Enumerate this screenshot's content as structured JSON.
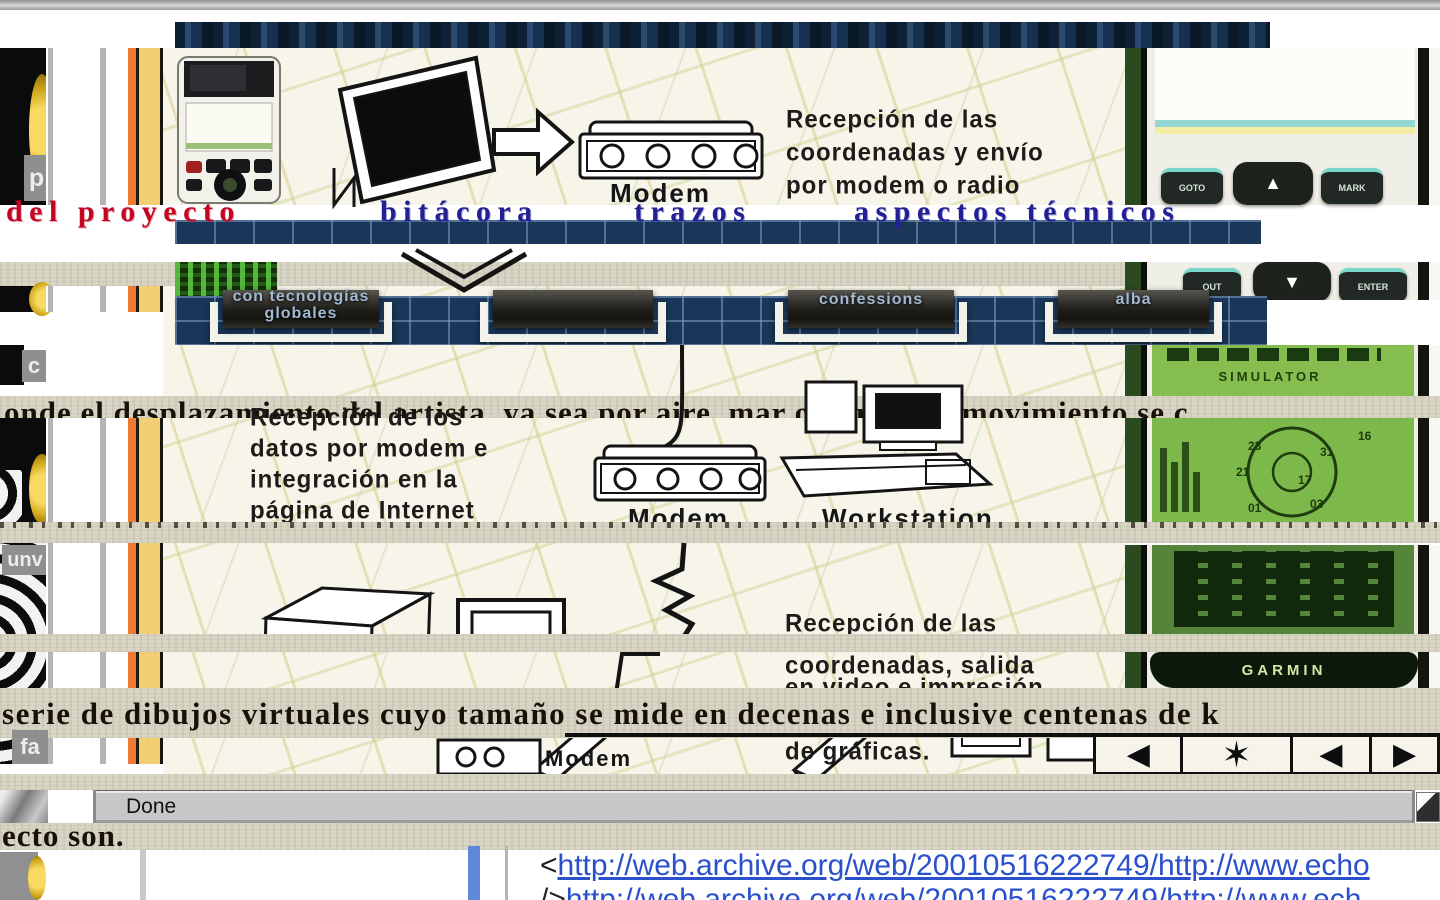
{
  "nav": {
    "item1": "del proyecto",
    "item2": "bitácora",
    "item3": "trazos",
    "item4": "aspectos técnicos"
  },
  "menu": {
    "btn1_line1": "con tecnologías",
    "btn1_line2": "globales",
    "btn2": "confessions",
    "btn3": "alba"
  },
  "diagram": {
    "cap1_l1": "Recepción de las",
    "cap1_l2": "coordenadas y envío",
    "cap1_l3": "por modem o radio",
    "cap2_l1": "Recepción de los",
    "cap2_l2": "datos por modem e",
    "cap2_l3": "integración en la",
    "cap2_l4": "página de Internet",
    "cap3_l1": "Recepción de las",
    "cap3_l2": "coordenadas, salida",
    "cap3_l3": "en video e impresión",
    "cap3_l4": "de gráficas.",
    "modem1": "Modem",
    "modem2": "Modem",
    "modem3": "Modem",
    "workstation": "Workstation"
  },
  "body": {
    "line1": "onde el desplazamiento del artista, ya sea por aire, mar o tierra; su movimiento se c",
    "line2": "serie de dibujos virtuales cuyo tamaño se mide en decenas e inclusive centenas de k",
    "line3": "ecto son."
  },
  "fragments": {
    "p": "p",
    "c": "c",
    "unv": "unv",
    "fa": "fa"
  },
  "gps": {
    "brand": "GARMIN",
    "screen_status": "SIMULATOR",
    "key_goto": "GOTO",
    "key_mark": "MARK",
    "key_out": "OUT",
    "key_enter": "ENTER",
    "sat_numbers": [
      "23",
      "21",
      "17",
      "31",
      "03",
      "01",
      "16"
    ]
  },
  "statusbar": {
    "text": "Done"
  },
  "links": {
    "url1_prefix": "<",
    "url1_text": "http://web.archive.org/web/20010516222749/http://www.echo",
    "url2_prefix": "/>",
    "url2_text": "http://web.archive.org/web/20010516222749/http://www.ech"
  },
  "icons": {
    "tape_rew": "◀",
    "tape_star": "✶",
    "tape_prev": "◀",
    "tape_play": "▶",
    "rocker_up": "▲",
    "rocker_down": "▼"
  },
  "colors": {
    "accent_red": "#c40423",
    "nav_blue": "#232096",
    "link_blue": "#2b50cc",
    "paper": "#d9d5c5",
    "navy": "#1a3658",
    "screen_green": "#7db94a"
  }
}
